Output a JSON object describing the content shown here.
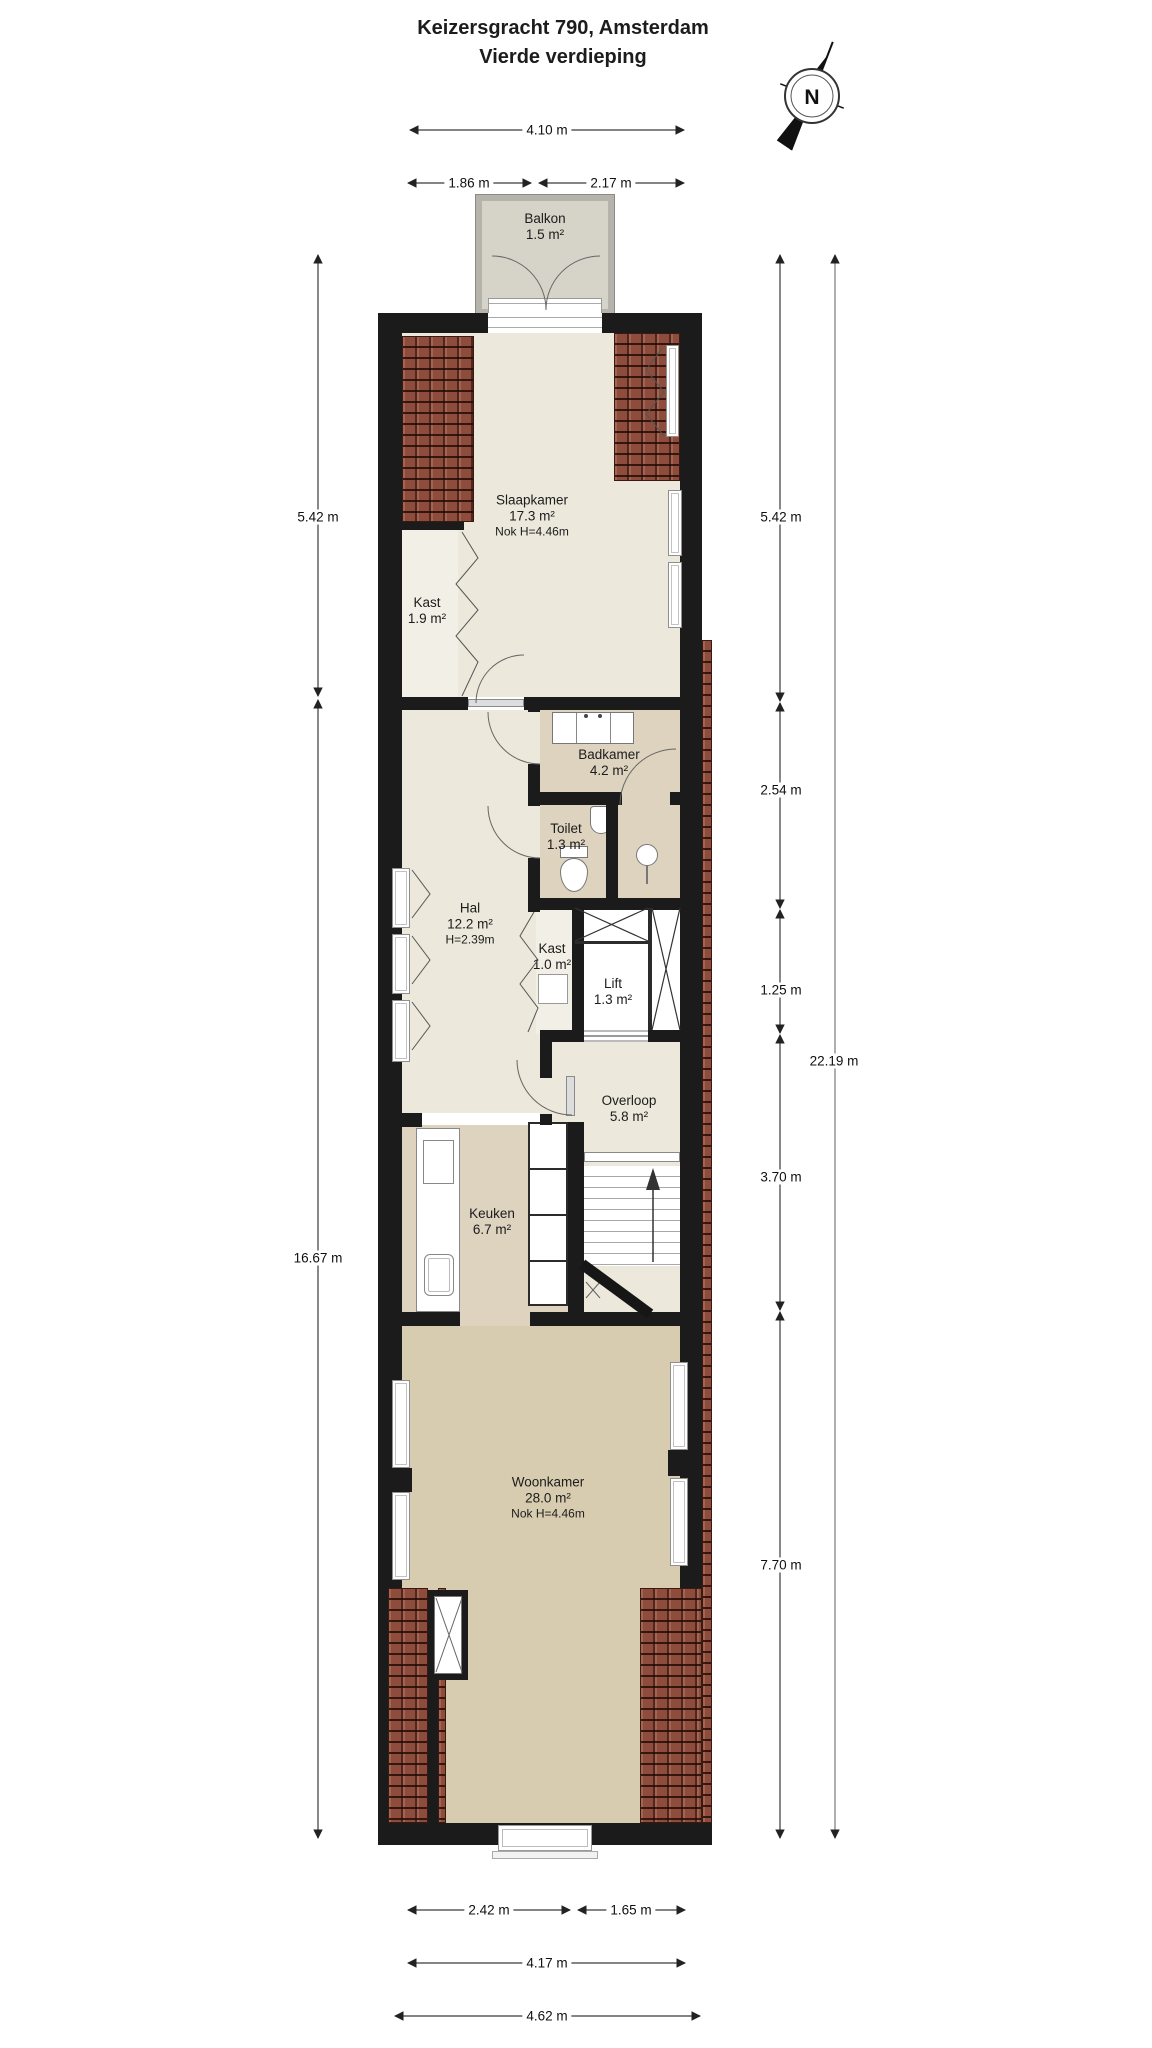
{
  "title": {
    "line1": "Keizersgracht 790, Amsterdam",
    "line2": "Vierde verdieping"
  },
  "compass": {
    "label": "N"
  },
  "rooms": {
    "balkon": {
      "name": "Balkon",
      "area": "1.5 m²"
    },
    "slaapkamer": {
      "name": "Slaapkamer",
      "area": "17.3 m²",
      "note": "Nok H=4.46m"
    },
    "kast_roof": {
      "name": "Kast"
    },
    "kast_slaapkamer": {
      "name": "Kast",
      "area": "1.9 m²"
    },
    "badkamer": {
      "name": "Badkamer",
      "area": "4.2 m²"
    },
    "toilet": {
      "name": "Toilet",
      "area": "1.3 m²"
    },
    "hal": {
      "name": "Hal",
      "area": "12.2 m²",
      "note": "H=2.39m"
    },
    "kast_hal": {
      "name": "Kast",
      "area": "1.0 m²"
    },
    "lift": {
      "name": "Lift",
      "area": "1.3 m²"
    },
    "overloop": {
      "name": "Overloop",
      "area": "5.8 m²"
    },
    "keuken": {
      "name": "Keuken",
      "area": "6.7 m²"
    },
    "woonkamer": {
      "name": "Woonkamer",
      "area": "28.0 m²",
      "note": "Nok H=4.46m"
    }
  },
  "dimensions": {
    "top_total": "4.10 m",
    "top_left": "1.86 m",
    "top_right": "2.17 m",
    "left_upper": "5.42 m",
    "left_lower": "16.67 m",
    "right_seg1": "5.42 m",
    "right_seg2": "2.54 m",
    "right_seg3": "1.25 m",
    "right_seg4": "3.70 m",
    "right_seg5": "7.70 m",
    "right_total": "22.19 m",
    "bottom_left": "2.42 m",
    "bottom_right": "1.65 m",
    "bottom_inner": "4.17 m",
    "bottom_total": "4.62 m"
  },
  "colors": {
    "wall": "#1b1b1b",
    "brick": "#8d4c3c",
    "floor-light": "#ece8db",
    "floor-tan": "#ddd3bf",
    "floor-dark": "#d8ccb0",
    "balkon-floor": "#d6d3c9",
    "line": "#3a3a3a"
  }
}
